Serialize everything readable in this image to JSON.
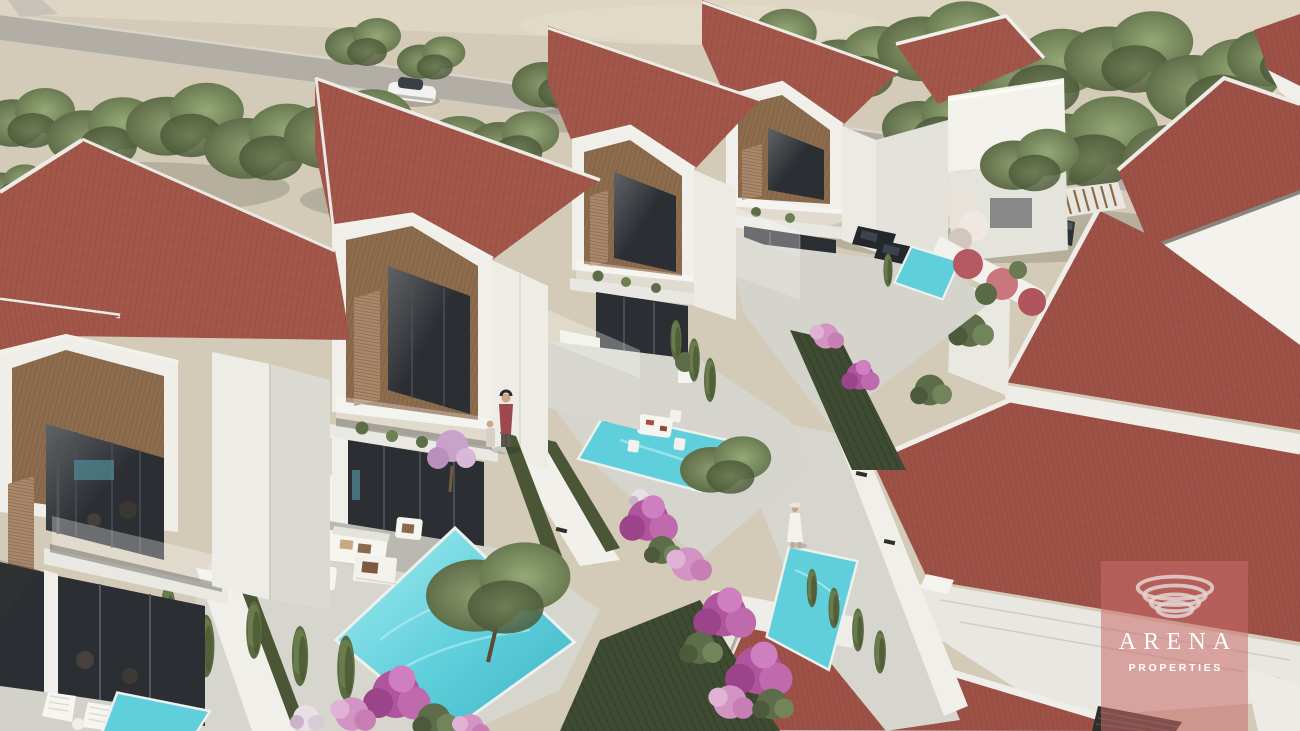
{
  "watermark": {
    "brand": "ARENA",
    "subtitle": "PROPERTIES"
  },
  "colors": {
    "sand": "#d3cab8",
    "sand_light": "#ded6c3",
    "road": "#b2aea5",
    "roof_front": "#a3574a",
    "roof_back": "#9e5147",
    "wall_white": "#f2f1eb",
    "wood": "#8d6c4e",
    "glass": "#2b2f33",
    "pool": "#5ecfdb",
    "deck": "#d6d5ce",
    "hedge": "#3e4a31",
    "grass": "#4a5635",
    "cypress": "#5a6b42",
    "bougainvillea": "#b1549e",
    "tree_green": "#6b7a52",
    "watermark_overlay": "#cb6b6a",
    "watermark_text": "#ffffff"
  },
  "scene": {
    "alt": "Aerial 3D architectural rendering of a row of modern two-storey villas with red tiled gable roofs, wooden gable cladding, glass balconies and private terraces with turquoise swimming pools, cypress trees and magenta bougainvillea; a second row of red tiled roofs on the right, and a tree-lined road with a single white car at the top."
  }
}
